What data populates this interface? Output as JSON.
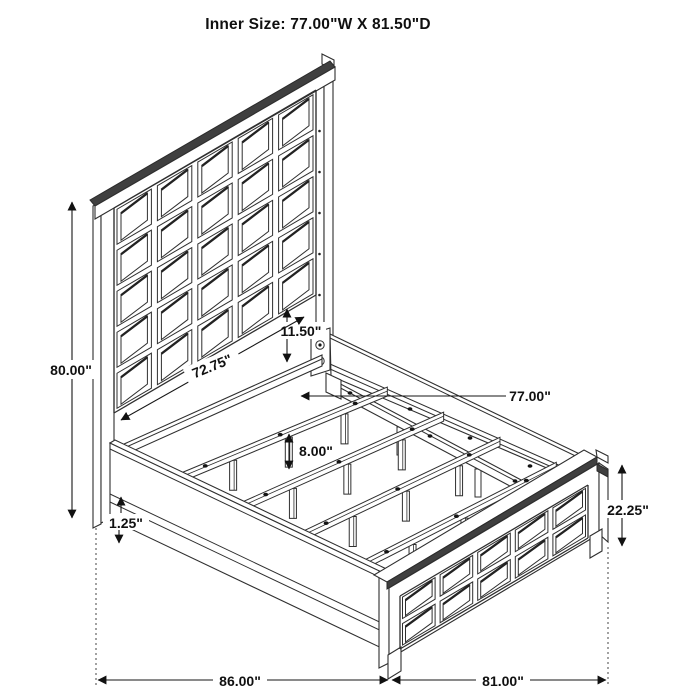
{
  "title": "Inner Size: 77.00\"W X 81.50\"D",
  "dimensions": {
    "headboard_height": "80.00\"",
    "panel_to_slat_gap": "11.50\"",
    "slat_rail_length": "72.75\"",
    "inner_width": "77.00\"",
    "slat_leg_height": "8.00\"",
    "side_rail_trim": "1.25\"",
    "footboard_height": "22.25\"",
    "overall_depth_left": "86.00\"",
    "overall_width_right": "81.00\""
  }
}
